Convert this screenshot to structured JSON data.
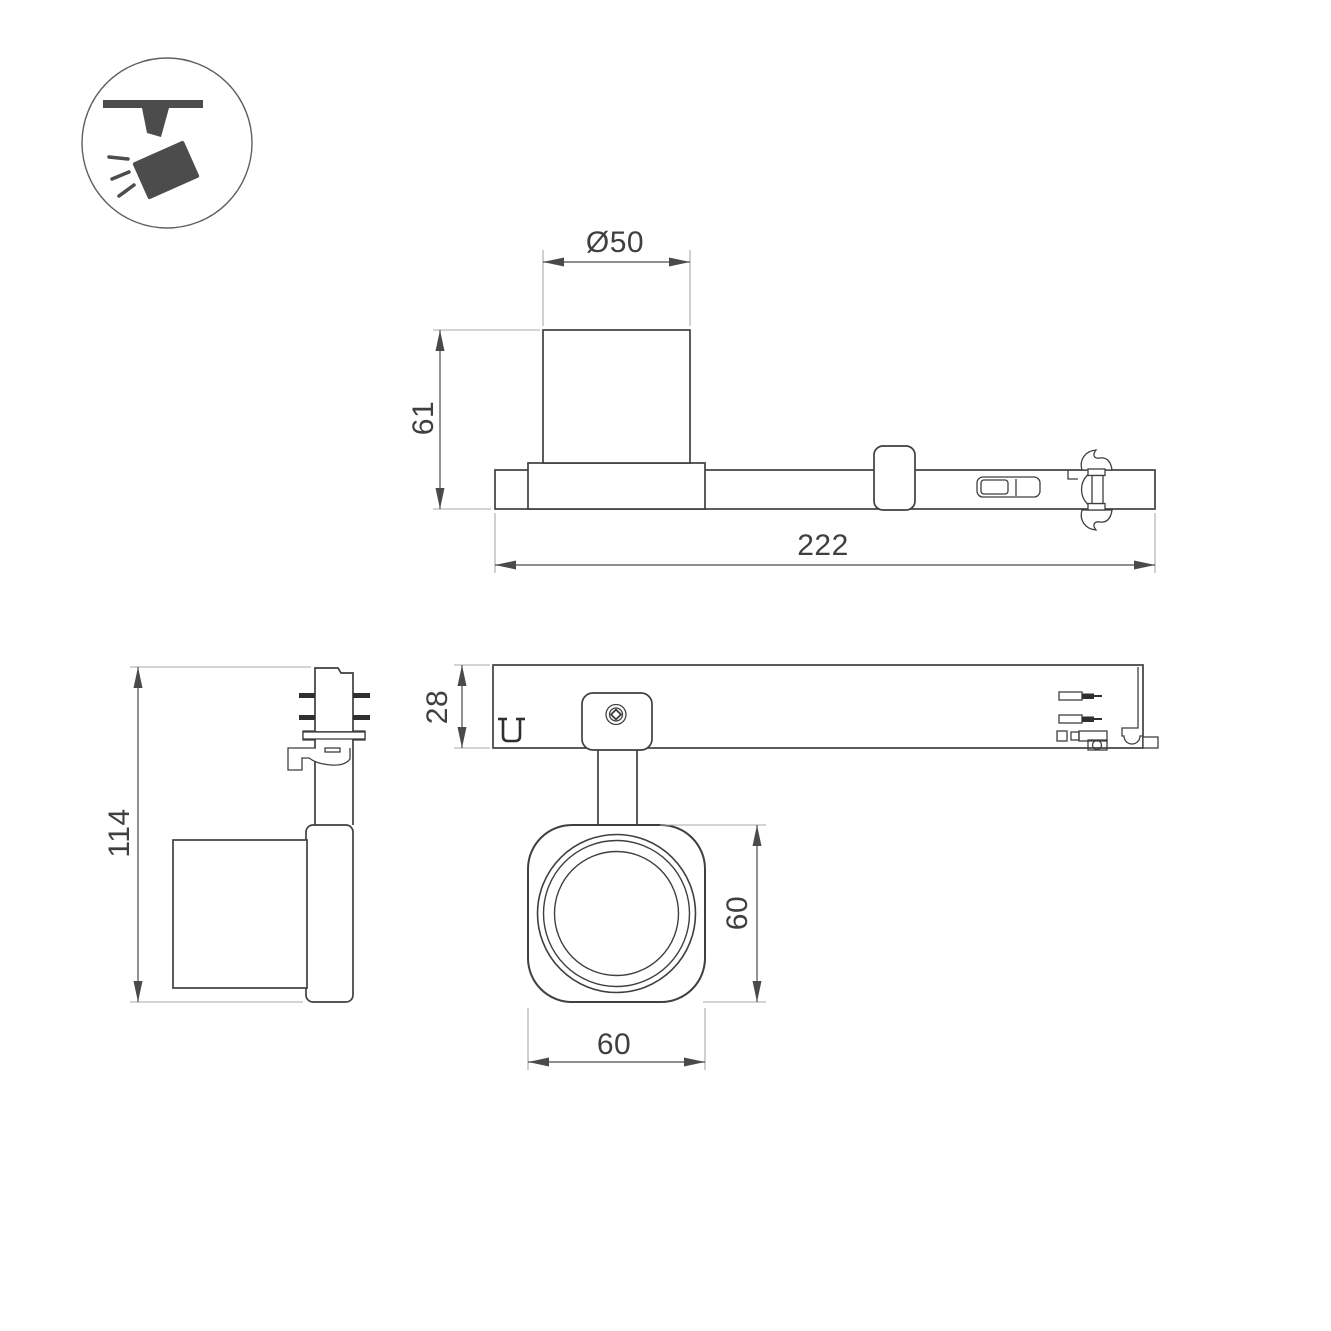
{
  "colors": {
    "background": "#ffffff",
    "object_line": "#3f3f3f",
    "dimension_line": "#4a4a4a",
    "extension_line": "#a8a8a8",
    "icon_fill": "#4c4c4c"
  },
  "icon": {
    "name": "ceiling-track-spotlight-pictogram"
  },
  "dimensions": {
    "side_view": {
      "diameter": "Ø50",
      "height": "61",
      "length": "222"
    },
    "end_view": {
      "height": "114"
    },
    "plan_view": {
      "depth": "28",
      "head_width": "60",
      "head_height": "60"
    }
  }
}
